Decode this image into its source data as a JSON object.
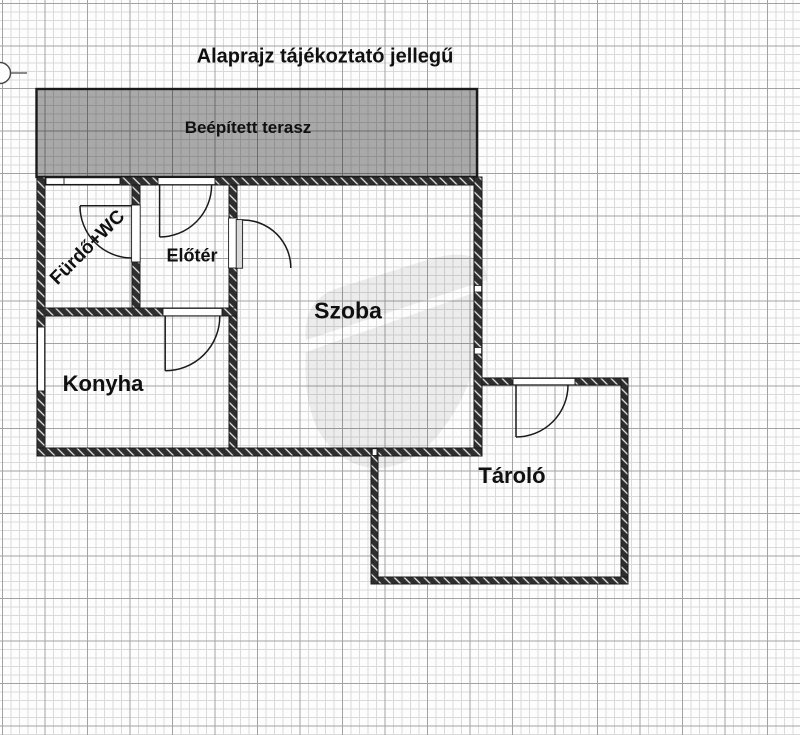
{
  "title": "Alaprajz tájékoztató jellegű",
  "rooms": {
    "terrace": "Beépített terasz",
    "bathroom": "Fürdő+WC",
    "hall": "Előtér",
    "room": "Szoba",
    "kitchen": "Konyha",
    "storage": "Tároló"
  },
  "colors": {
    "terrace_fill": "#a8a8a8",
    "wall": "#2e2e2e",
    "grid_minor": "#dadada",
    "grid_major": "#a2a2a2",
    "paper": "#fdfdfd",
    "text": "#101010",
    "watermark": "#ededed"
  }
}
